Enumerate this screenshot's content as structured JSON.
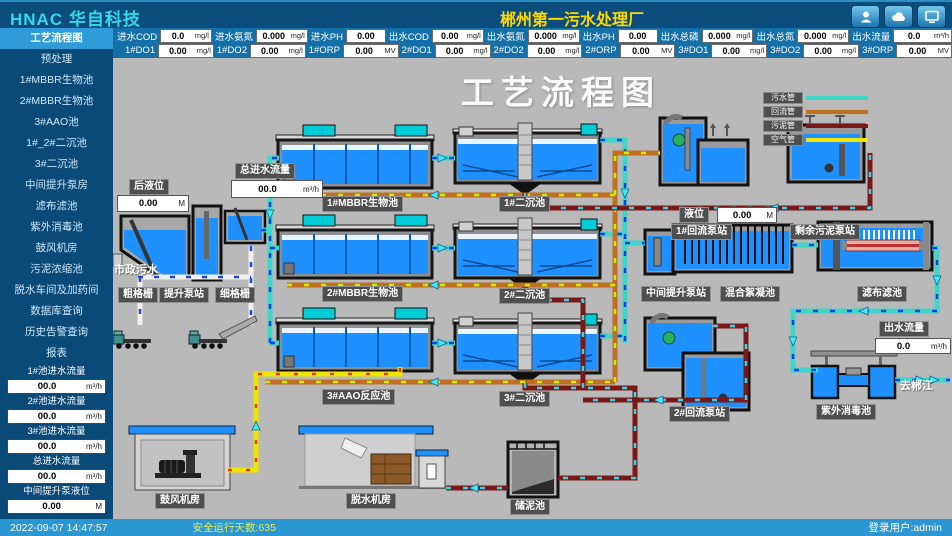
{
  "header": {
    "logo": "HNAC 华自科技",
    "title": "郴州第一污水处理厂",
    "icons": [
      "user-icon",
      "cloud-icon",
      "monitor-icon"
    ]
  },
  "metrics_row1": [
    {
      "label": "进水COD",
      "value": "0.0",
      "unit": "mg/l"
    },
    {
      "label": "进水氨氮",
      "value": "0.000",
      "unit": "mg/l"
    },
    {
      "label": "进水PH",
      "value": "0.00",
      "unit": ""
    },
    {
      "label": "出水COD",
      "value": "0.00",
      "unit": "mg/l"
    },
    {
      "label": "出水氨氮",
      "value": "0.000",
      "unit": "mg/l"
    },
    {
      "label": "出水PH",
      "value": "0.00",
      "unit": ""
    },
    {
      "label": "出水总磷",
      "value": "0.000",
      "unit": "mg/l"
    },
    {
      "label": "出水总氮",
      "value": "0.000",
      "unit": "mg/l"
    },
    {
      "label": "出水流量",
      "value": "0.0",
      "unit": "m³/h"
    }
  ],
  "metrics_row2": [
    {
      "label": "1#DO1",
      "value": "0.00",
      "unit": "mg/l"
    },
    {
      "label": "1#DO2",
      "value": "0.00",
      "unit": "mg/l"
    },
    {
      "label": "1#ORP",
      "value": "0.00",
      "unit": "MV"
    },
    {
      "label": "2#DO1",
      "value": "0.00",
      "unit": "mg/l"
    },
    {
      "label": "2#DO2",
      "value": "0.00",
      "unit": "mg/l"
    },
    {
      "label": "2#ORP",
      "value": "0.00",
      "unit": "MV"
    },
    {
      "label": "3#DO1",
      "value": "0.00",
      "unit": "mg/l"
    },
    {
      "label": "3#DO2",
      "value": "0.00",
      "unit": "mg/l"
    },
    {
      "label": "3#ORP",
      "value": "0.00",
      "unit": "MV"
    }
  ],
  "sidebar": {
    "items": [
      "工艺流程图",
      "预处理",
      "1#MBBR生物池",
      "2#MBBR生物池",
      "3#AAO池",
      "1#_2#二沉池",
      "3#二沉池",
      "中间提升泵房",
      "滤布滤池",
      "紫外消毒池",
      "鼓风机房",
      "污泥浓缩池",
      "脱水车间及加药间",
      "数据库查询",
      "历史告警查询",
      "报表"
    ],
    "selected": "工艺流程图",
    "fields": [
      {
        "label": "1#池进水流量",
        "value": "00.0",
        "unit": "m³/h"
      },
      {
        "label": "2#池进水流量",
        "value": "00.0",
        "unit": "m³/h"
      },
      {
        "label": "3#池进水流量",
        "value": "00.0",
        "unit": "m³/h"
      },
      {
        "label": "总进水流量",
        "value": "00.0",
        "unit": "m³/h"
      },
      {
        "label": "中间提升泵液位",
        "value": "0.00",
        "unit": "M"
      }
    ]
  },
  "diagram": {
    "title": "工艺流程图",
    "legend": [
      {
        "label": "污水管",
        "color": "#3ED6C8"
      },
      {
        "label": "回流管",
        "color": "#C07020"
      },
      {
        "label": "污泥管",
        "color": "#7A1818"
      },
      {
        "label": "空气管",
        "color": "#F0E600"
      }
    ],
    "labels": {
      "coarse_screen": "粗格栅",
      "lift_station": "提升泵站",
      "fine_screen": "细格栅",
      "municipal_sewage": "市政污水",
      "mbbr1": "1#MBBR生物池",
      "mbbr2": "2#MBBR生物池",
      "aao3": "3#AAO反应池",
      "clarifier1": "1#二沉池",
      "clarifier2": "2#二沉池",
      "clarifier3": "3#二沉池",
      "return_station1": "1#回流泵站",
      "excess_sludge_station": "剩余污泥泵站",
      "mid_lift_station": "中间提升泵站",
      "mixing_tank": "混合絮凝池",
      "cloth_filter": "滤布滤池",
      "return_station2": "2#回流泵站",
      "uv_tank": "紫外消毒池",
      "blower_room": "鼓风机房",
      "dewater_room": "脱水机房",
      "sludge_tank": "储泥池",
      "to_river": "去郴江"
    },
    "fields": {
      "rear_level": {
        "label": "后液位",
        "value": "0.00",
        "unit": "M"
      },
      "total_inflow": {
        "label": "总进水流量",
        "value": "00.0",
        "unit": "m³/h"
      },
      "level": {
        "label": "液位",
        "value": "0.00",
        "unit": "M"
      },
      "outflow": {
        "label": "出水流量",
        "value": "0.0",
        "unit": "m³/h"
      }
    }
  },
  "statusbar": {
    "datetime": "2022-09-07  14:47:57",
    "safe_days": "安全运行天数:635",
    "user": "登录用户:admin"
  }
}
